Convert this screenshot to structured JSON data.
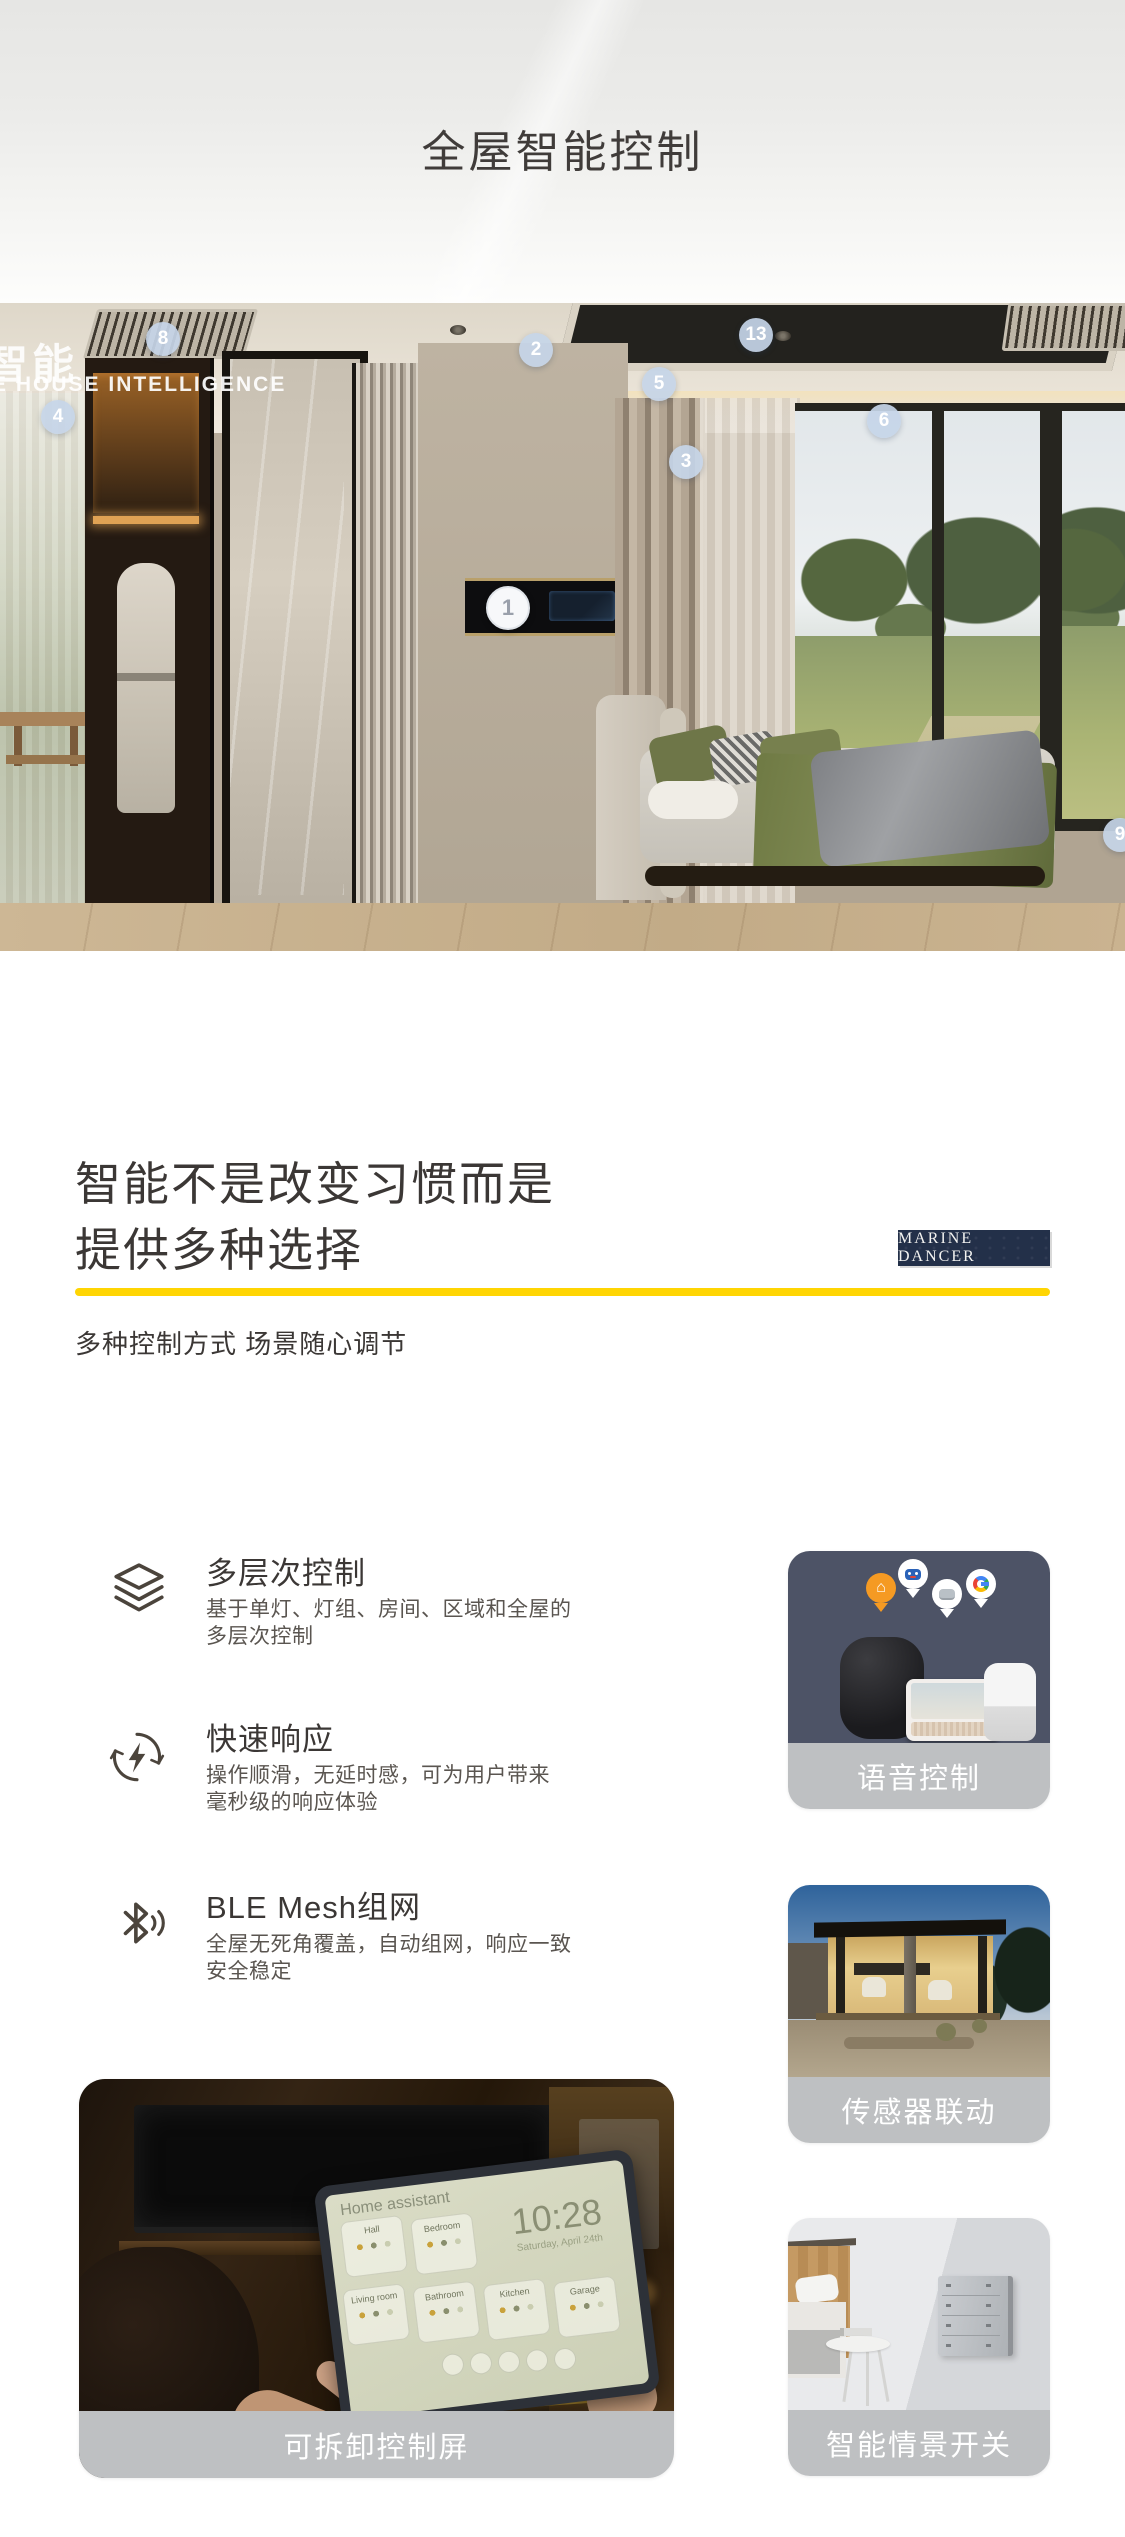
{
  "page": {
    "title": "全屋智能控制"
  },
  "hero": {
    "overlay_line1": "智能",
    "overlay_line2": "E HOUSE INTELLIGENCE",
    "markers": [
      {
        "n": "8"
      },
      {
        "n": "2"
      },
      {
        "n": "13"
      },
      {
        "n": "5"
      },
      {
        "n": "6"
      },
      {
        "n": "4"
      },
      {
        "n": "3"
      },
      {
        "n": "9"
      }
    ],
    "panel_marker": {
      "n": "1"
    }
  },
  "section": {
    "heading_line1": "智能不是改变习惯而是",
    "heading_line2": "提供多种选择",
    "brand_badge": "MARINE DANCER",
    "subtitle": "多种控制方式 场景随心调节",
    "accent_color": "#ffd503"
  },
  "features": [
    {
      "icon": "layers-icon",
      "title": "多层次控制",
      "desc_line1": "基于单灯、灯组、房间、区域和全屋的",
      "desc_line2": "多层次控制"
    },
    {
      "icon": "fast-response-icon",
      "title": "快速响应",
      "desc_line1": "操作顺滑，无延时感，可为用户带来",
      "desc_line2": "毫秒级的响应体验"
    },
    {
      "icon": "bluetooth-mesh-icon",
      "title": "BLE Mesh组网",
      "desc_line1": "全屋无死角覆盖，自动组网，响应一致",
      "desc_line2": "安全稳定"
    }
  ],
  "cards": [
    {
      "caption": "语音控制"
    },
    {
      "caption": "传感器联动"
    },
    {
      "caption": "智能情景开关"
    },
    {
      "caption": "可拆卸控制屏"
    }
  ],
  "tablet_ui": {
    "app_title": "Home assistant",
    "time": "10:28",
    "date": "Saturday, April 24th",
    "rooms": [
      "Hall",
      "Bedroom",
      "Living room",
      "Bathroom",
      "Kitchen",
      "Garage"
    ]
  }
}
